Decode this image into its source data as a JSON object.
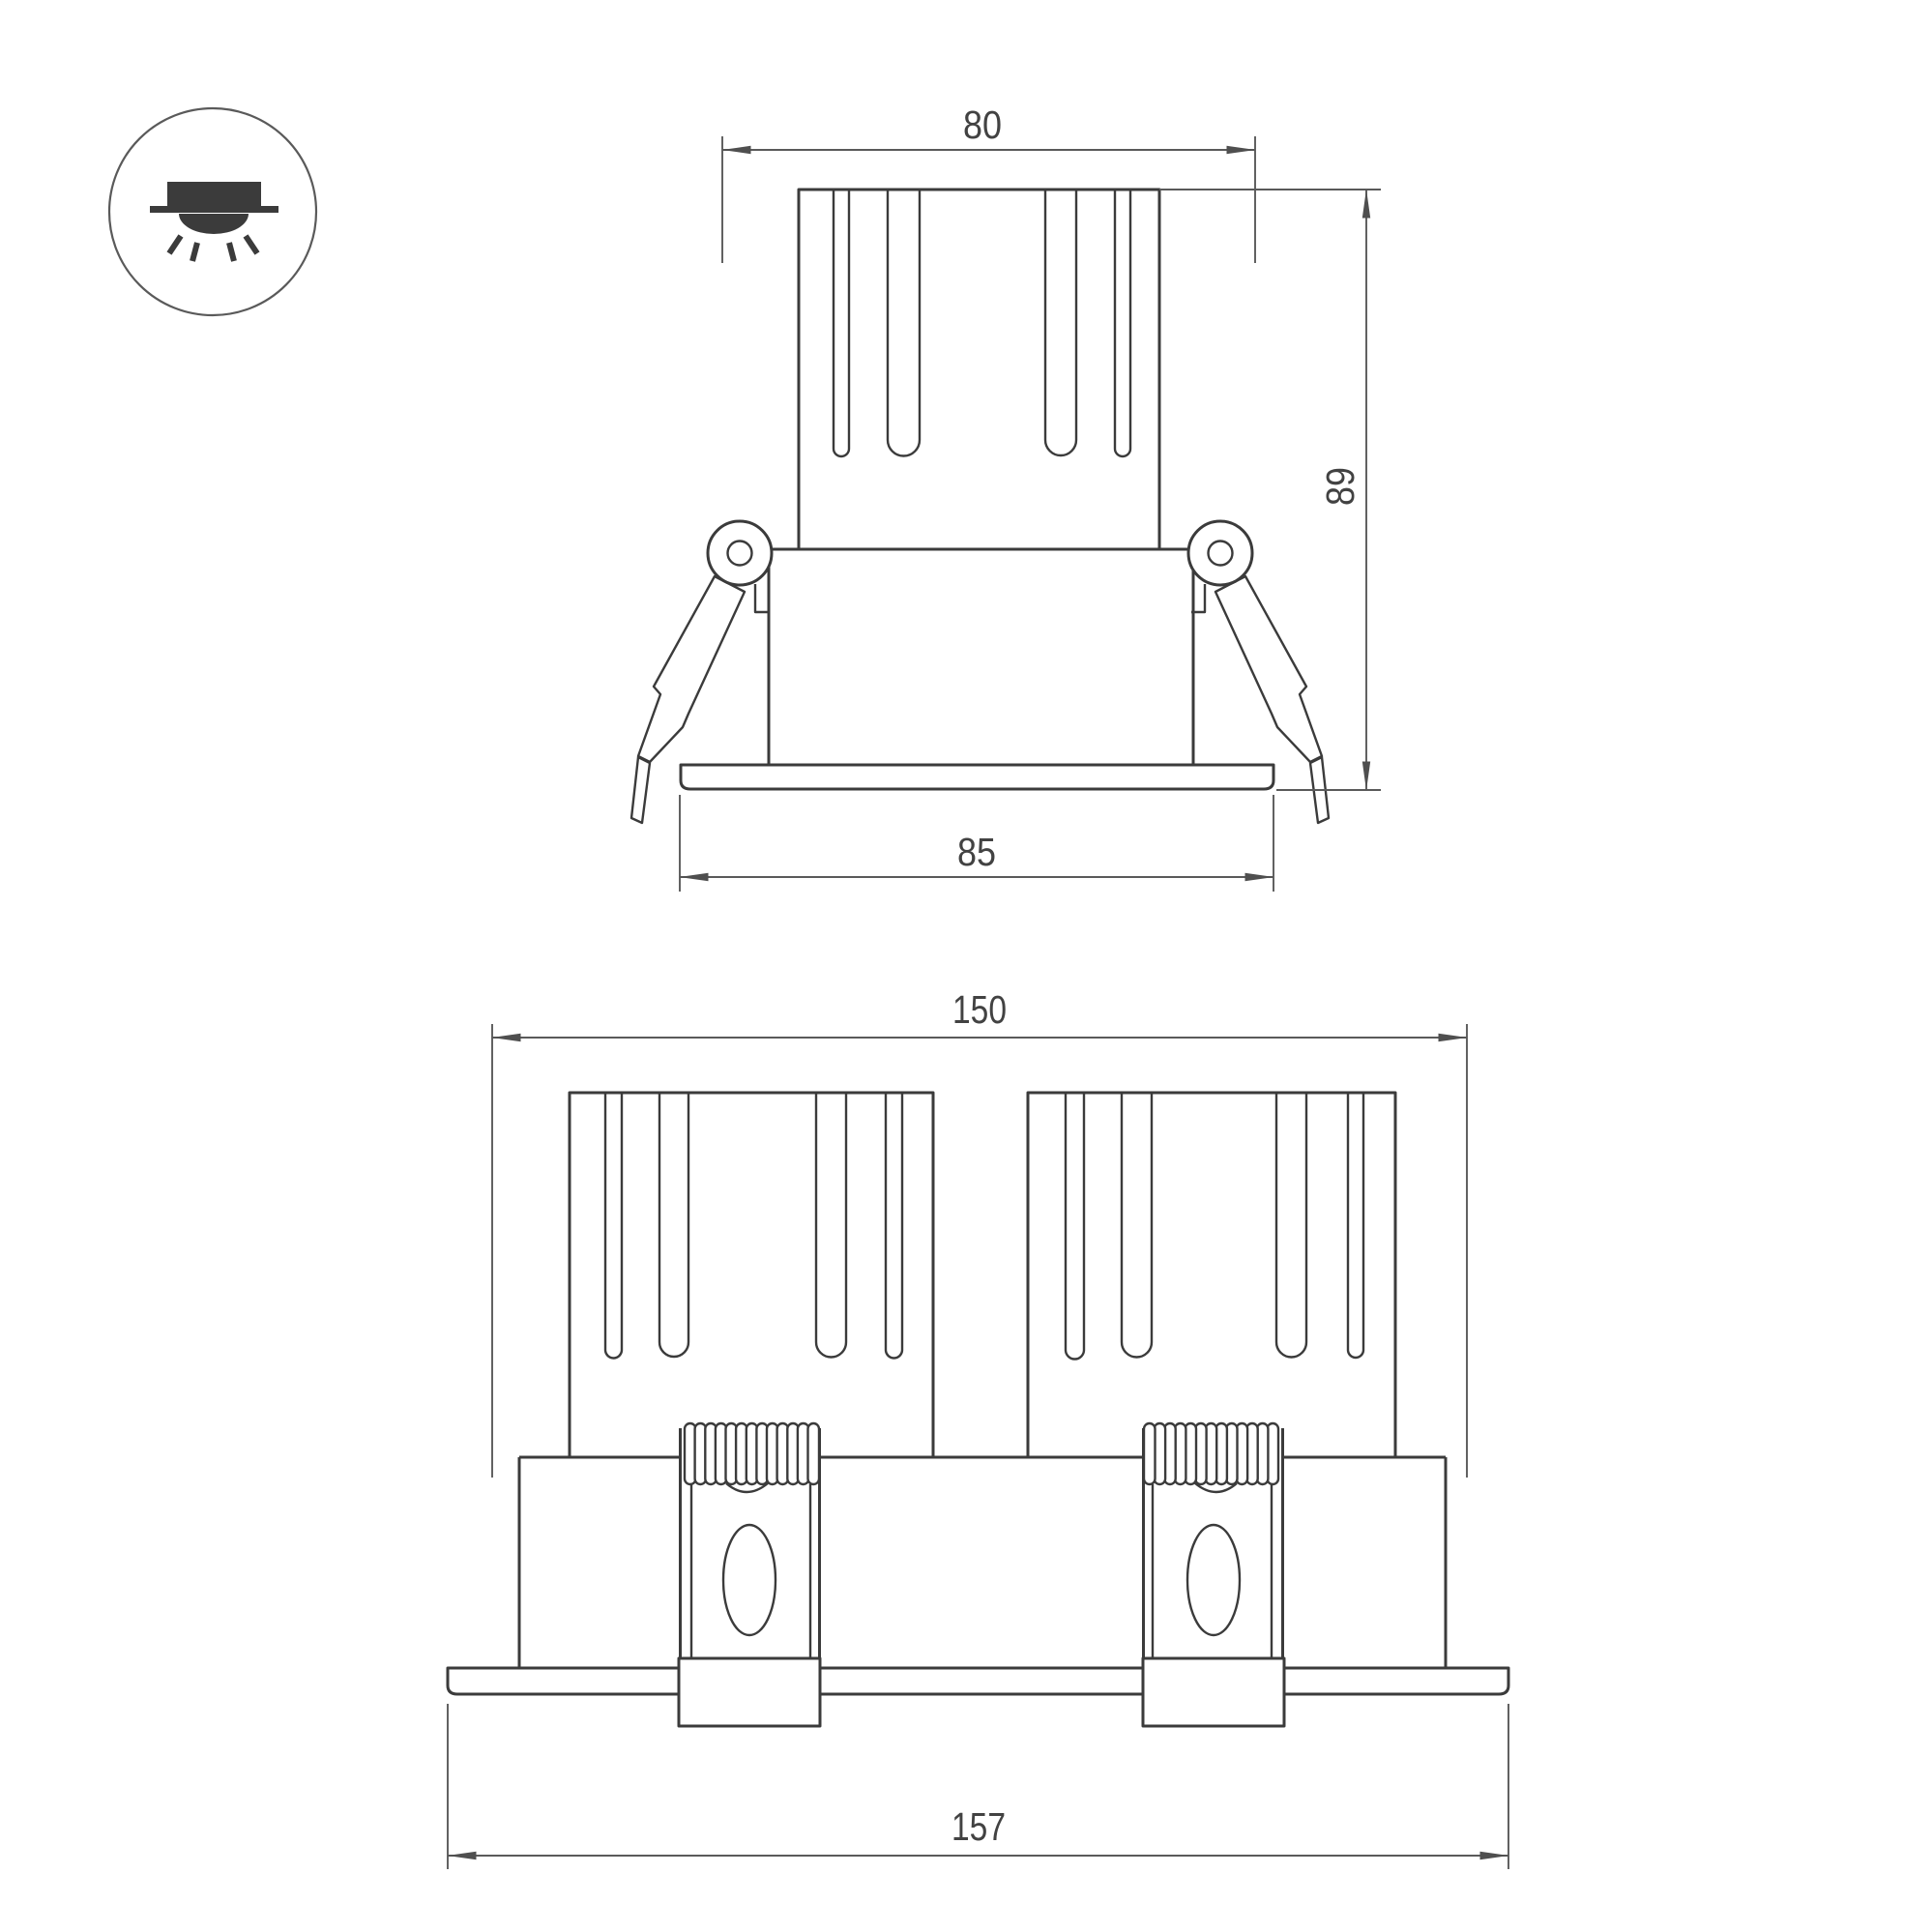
{
  "colors": {
    "line": "#3b3b3b",
    "dim": "#5a5a5a",
    "text": "#424242",
    "background": "#ffffff"
  },
  "icon": {
    "name": "recessed-downlight-mounting-icon"
  },
  "views": {
    "single": {
      "name": "single-head front view",
      "width_top": "80",
      "height": "89",
      "width_flange": "85"
    },
    "double": {
      "name": "double-head front view",
      "width_body": "150",
      "width_flange": "157"
    }
  }
}
